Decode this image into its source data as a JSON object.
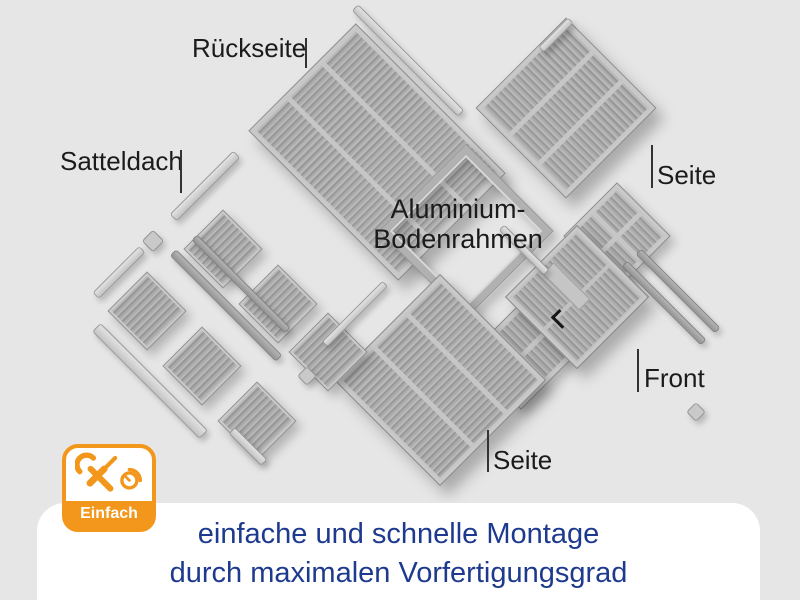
{
  "colors": {
    "background": "#e6e6e6",
    "panel_gray": "#a8a8a8",
    "rail_light": "#d4d4d4",
    "accent_orange": "#f2971b",
    "caption_navy": "#1e3a8f",
    "label_black": "#1b1b1b",
    "caption_panel_white": "#ffffff"
  },
  "labels": {
    "rueckseite": "Rückseite",
    "satteldach": "Satteldach",
    "bodenrahmen_line1": "Aluminium-",
    "bodenrahmen_line2": "Bodenrahmen",
    "seite_right": "Seite",
    "seite_bottom": "Seite",
    "front": "Front"
  },
  "badge": {
    "label": "Einfach",
    "icons": [
      "wrench-icon",
      "screwdriver-icon",
      "clock-icon"
    ]
  },
  "caption": {
    "line1": "einfache und schnelle Montage",
    "line2": "durch maximalen Vorfertigungsgrad"
  },
  "diagram": {
    "panels": [
      {
        "name": "rueckseite-panel",
        "kind": "wall",
        "cx": 377,
        "cy": 152,
        "w": 150,
        "h": 210,
        "rot": -45,
        "cols": 3,
        "shadow": "lg"
      },
      {
        "name": "seite-right-panel",
        "kind": "wall",
        "cx": 566,
        "cy": 108,
        "w": 126,
        "h": 126,
        "rot": 45,
        "cols": 3,
        "shadow": "lg"
      },
      {
        "name": "floor-frame",
        "kind": "frame",
        "cx": 466,
        "cy": 231,
        "w": 122,
        "h": 122,
        "rot": 45,
        "shadow": "md"
      },
      {
        "name": "front-side-panel-right",
        "kind": "grid",
        "cx": 617,
        "cy": 236,
        "w": 74,
        "h": 74,
        "rot": 45,
        "shadow": "md"
      },
      {
        "name": "front-side-panel-left",
        "kind": "grid",
        "cx": 521,
        "cy": 356,
        "w": 74,
        "h": 74,
        "rot": 45,
        "shadow": "md"
      },
      {
        "name": "front-door-panel",
        "kind": "door",
        "cx": 577,
        "cy": 297,
        "w": 100,
        "h": 100,
        "rot": 45,
        "shadow": "lg"
      },
      {
        "name": "seite-bottom-panel",
        "kind": "wall",
        "cx": 440,
        "cy": 380,
        "w": 148,
        "h": 148,
        "rot": -45,
        "cols": 3,
        "shadow": "lg"
      },
      {
        "name": "roof-panel-1",
        "kind": "roof",
        "cx": 223,
        "cy": 249,
        "w": 54,
        "h": 54,
        "rot": -45,
        "shadow": "md"
      },
      {
        "name": "roof-panel-2",
        "kind": "roof",
        "cx": 278,
        "cy": 304,
        "w": 54,
        "h": 54,
        "rot": -45,
        "shadow": "md"
      },
      {
        "name": "roof-panel-3",
        "kind": "roof",
        "cx": 328,
        "cy": 352,
        "w": 54,
        "h": 54,
        "rot": -45,
        "shadow": "md"
      },
      {
        "name": "roof-panel-4",
        "kind": "roof",
        "cx": 147,
        "cy": 311,
        "w": 54,
        "h": 54,
        "rot": -45,
        "shadow": "md"
      },
      {
        "name": "roof-panel-5",
        "kind": "roof",
        "cx": 202,
        "cy": 366,
        "w": 54,
        "h": 54,
        "rot": -45,
        "shadow": "md"
      },
      {
        "name": "roof-panel-6",
        "kind": "roof",
        "cx": 257,
        "cy": 421,
        "w": 54,
        "h": 54,
        "rot": -45,
        "shadow": "md"
      }
    ],
    "bars": [
      {
        "name": "roof-ridge-rail-1",
        "cx": 205,
        "cy": 186,
        "len": 90,
        "w": 10,
        "rot": -45,
        "tone": "light"
      },
      {
        "name": "roof-ridge-rail-2",
        "cx": 119,
        "cy": 272,
        "len": 66,
        "w": 9,
        "rot": -45,
        "tone": "light"
      },
      {
        "name": "roof-edge-rail-1",
        "cx": 226,
        "cy": 305,
        "len": 150,
        "w": 9,
        "rot": 45,
        "tone": "mid"
      },
      {
        "name": "roof-edge-rail-2",
        "cx": 241,
        "cy": 284,
        "len": 132,
        "w": 8,
        "rot": 45,
        "tone": "mid"
      },
      {
        "name": "roof-front-trim-rail",
        "cx": 150,
        "cy": 381,
        "len": 152,
        "w": 12,
        "rot": 45,
        "tone": "light"
      },
      {
        "name": "roof-small-rail",
        "cx": 248,
        "cy": 446,
        "len": 46,
        "w": 9,
        "rot": 45,
        "tone": "light"
      },
      {
        "name": "back-panel-top-rail",
        "cx": 408,
        "cy": 60,
        "len": 150,
        "w": 9,
        "rot": 45,
        "tone": "light"
      },
      {
        "name": "seite-right-cap-rail",
        "cx": 556,
        "cy": 35,
        "len": 42,
        "w": 8,
        "rot": -45,
        "tone": "light"
      },
      {
        "name": "seite-bottom-edge-rail",
        "cx": 355,
        "cy": 314,
        "len": 86,
        "w": 8,
        "rot": -45,
        "tone": "light"
      },
      {
        "name": "front-top-rail",
        "cx": 524,
        "cy": 250,
        "len": 64,
        "w": 8,
        "rot": 45,
        "tone": "light"
      },
      {
        "name": "front-right-rail-1",
        "cx": 664,
        "cy": 303,
        "len": 112,
        "w": 8,
        "rot": 45,
        "tone": "mid"
      },
      {
        "name": "front-right-rail-2",
        "cx": 678,
        "cy": 291,
        "len": 112,
        "w": 8,
        "rot": 45,
        "tone": "mid"
      }
    ],
    "caps": [
      {
        "name": "corner-cap-1",
        "cx": 153,
        "cy": 241,
        "s": 16
      },
      {
        "name": "corner-cap-2",
        "cx": 307,
        "cy": 376,
        "s": 14
      },
      {
        "name": "corner-cap-3",
        "cx": 696,
        "cy": 412,
        "s": 14
      }
    ]
  }
}
